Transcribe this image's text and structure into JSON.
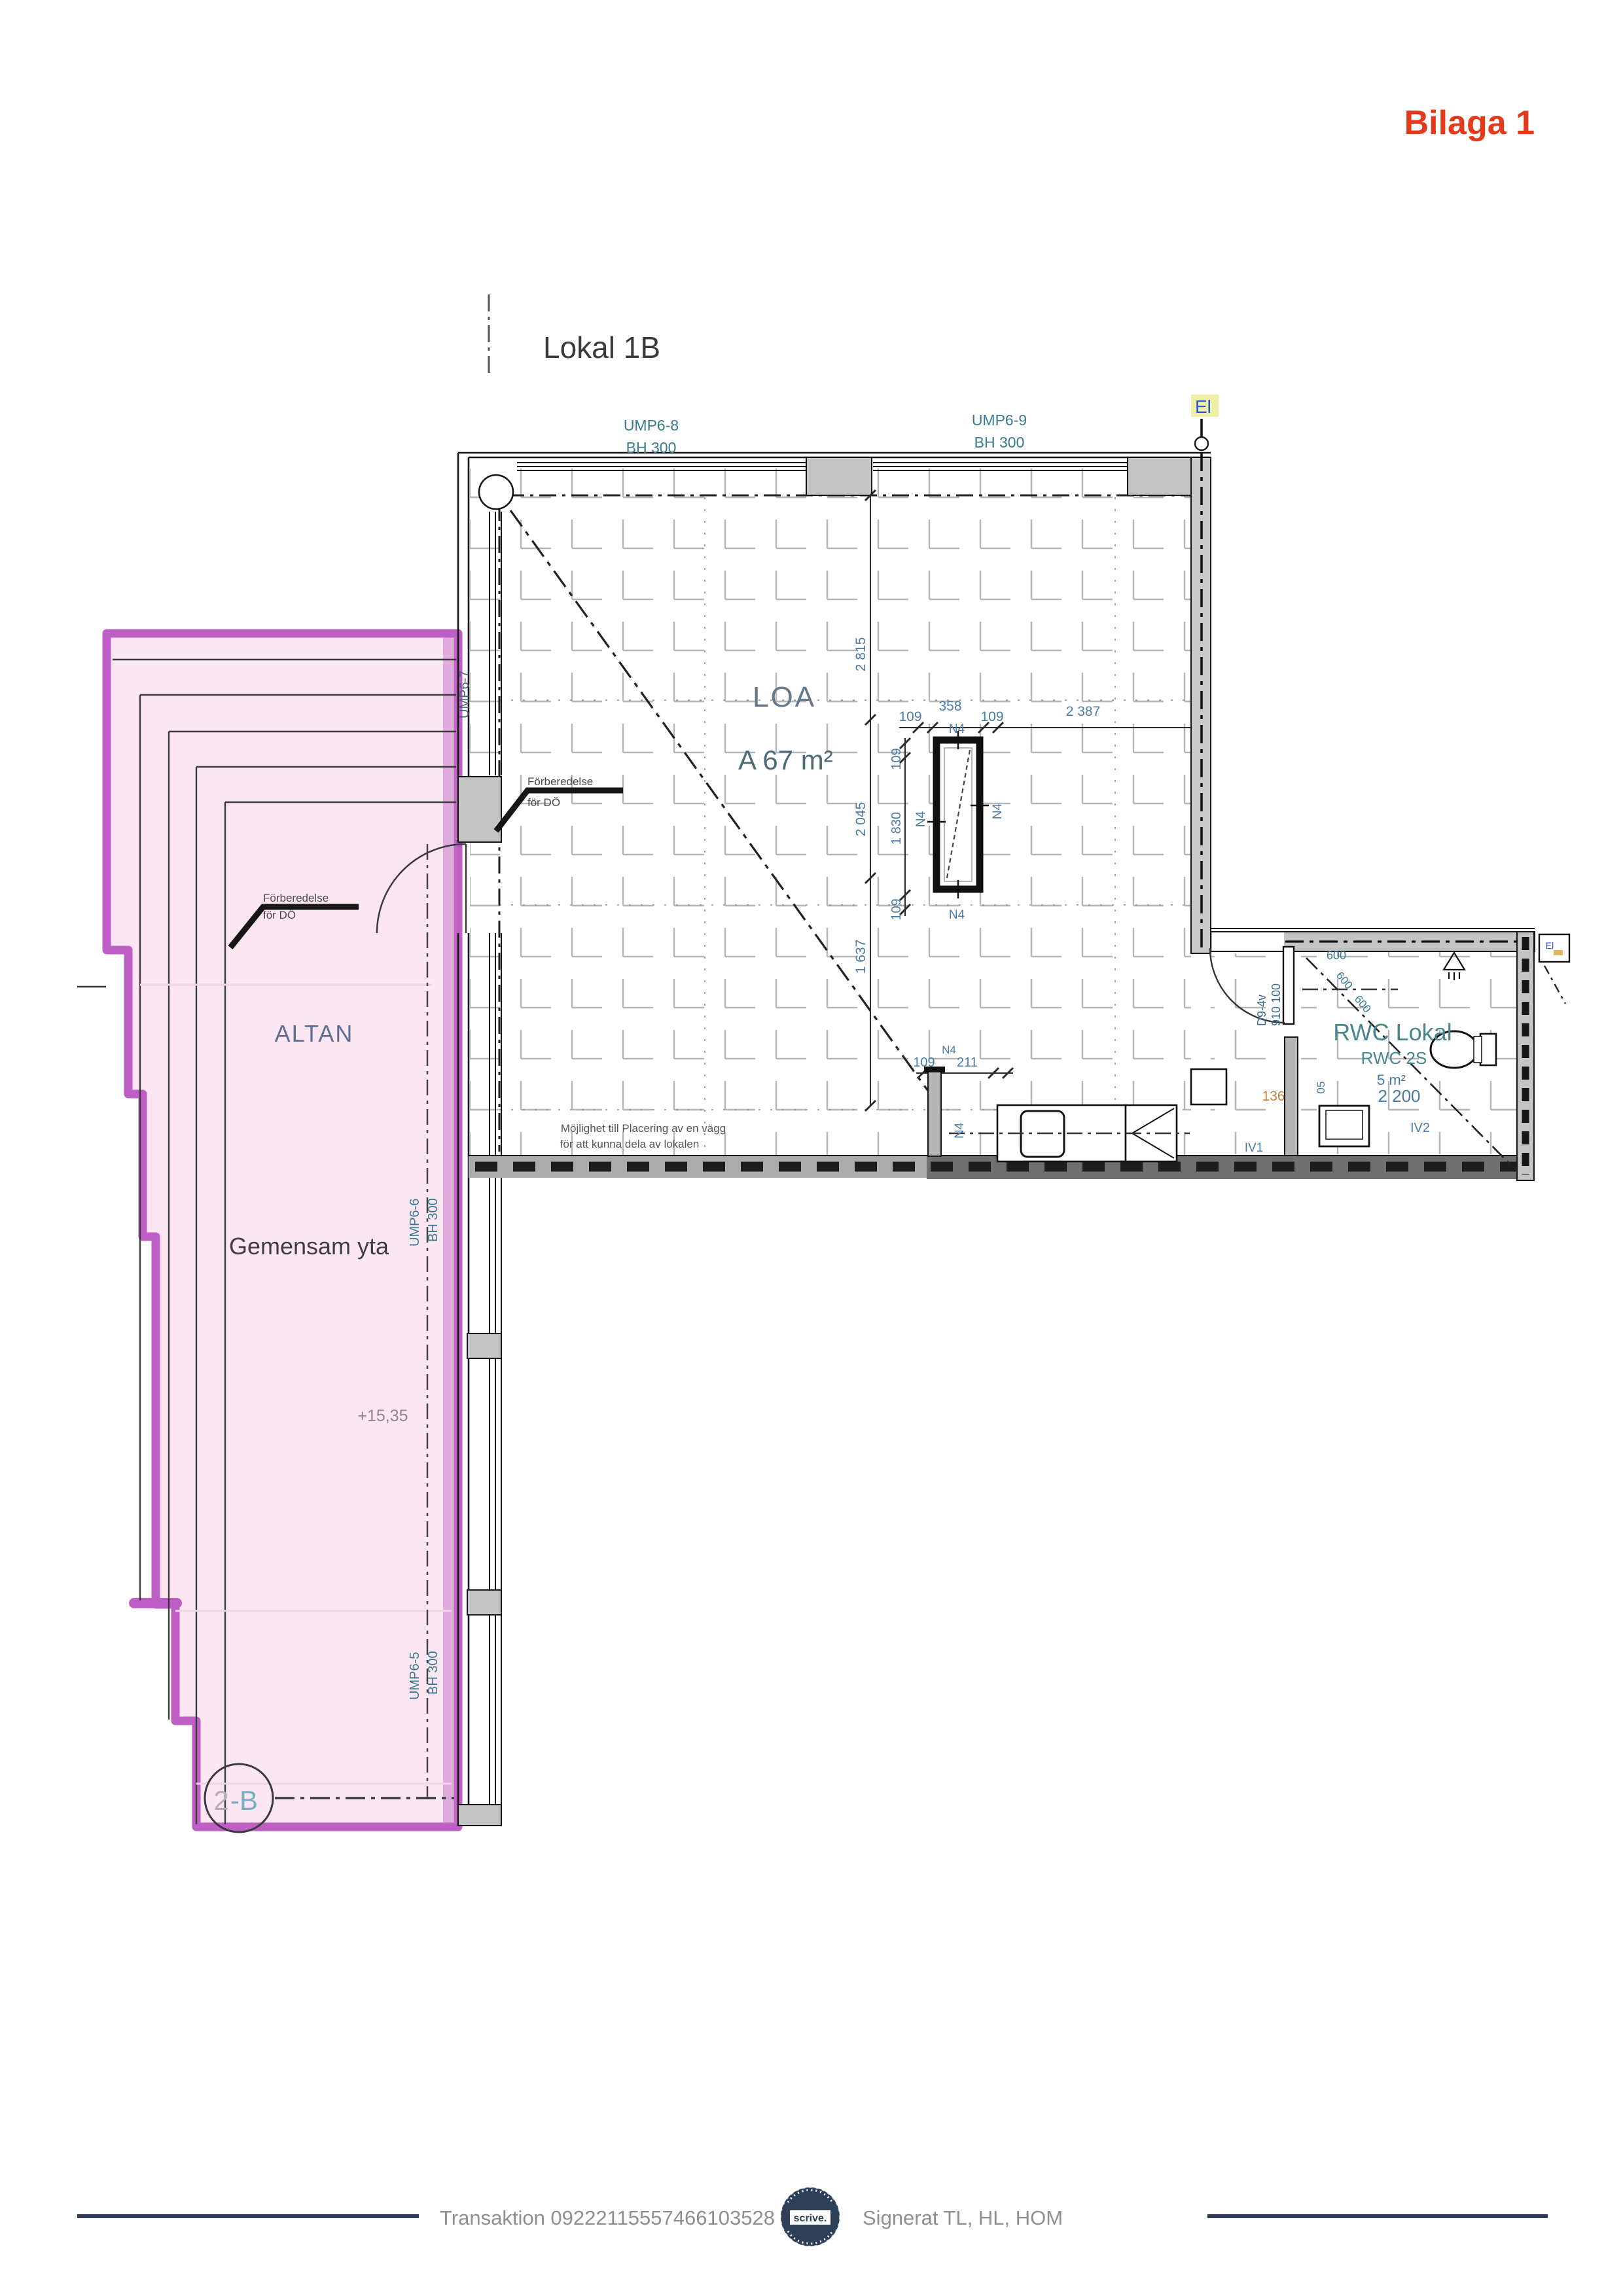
{
  "header": {
    "bilaga": "Bilaga 1"
  },
  "title": {
    "label": "Lokal 1B"
  },
  "facade": {
    "ump6_8": "UMP6-8",
    "ump6_9": "UMP6-9",
    "ump6_7": "UMP6-7",
    "ump6_6": "UMP6-6",
    "ump6_5": "UMP6-5",
    "bh": "BH 300"
  },
  "room": {
    "loa": "LOA",
    "area": "A  67  m²",
    "el": "El",
    "note1": "Möjlighet till Placering av en vägg",
    "note2": "för att kunna dela av lokalen"
  },
  "terrace": {
    "altan": "ALTAN",
    "gemensam": "Gemensam yta",
    "level": "+15,35",
    "marker_left": "2",
    "marker_right": "-B",
    "prep1": "Förberedelse",
    "prep2": "för DÖ"
  },
  "rwc": {
    "name": "RWC Lokal",
    "id": "RWC 2S",
    "area": "5 m²",
    "dim2200": "2 200",
    "door": "D9-4v",
    "door_dim": "910 100",
    "iv1": "IV1",
    "iv2": "IV2",
    "dim136": "136",
    "dim600": "600",
    "el_small": "El"
  },
  "dims": {
    "d109": "109",
    "d358": "358",
    "d2387": "2 387",
    "d2815": "2 815",
    "d2045": "2 045",
    "d1830": "1 830",
    "d1637": "1 637",
    "d211": "211",
    "n4": "N4",
    "d05": "05"
  },
  "footer": {
    "transaction": "Transaktion 09222115557466103528",
    "signed": "Signerat TL, HL, HOM",
    "badge": "scrive."
  }
}
